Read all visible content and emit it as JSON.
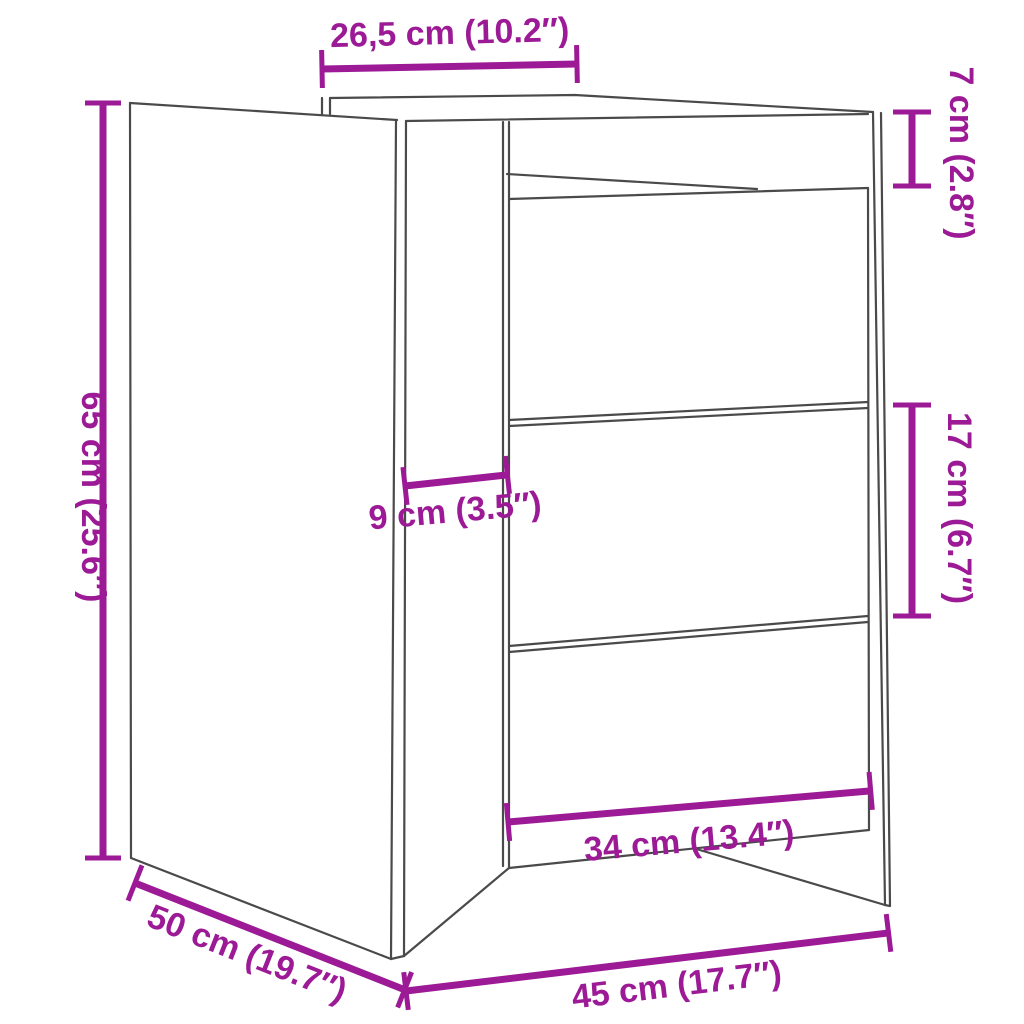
{
  "figure": {
    "kind": "furniture-dimension-diagram",
    "subject": "bedside cabinet with 3 drawers and open top compartment, perspective line drawing",
    "colors": {
      "dimension_accent": "#9c1a96",
      "drawing_outline": "#4a4a4a",
      "background": "#ffffff"
    }
  },
  "labels": {
    "top_depth": "26,5 cm (10.2″)",
    "top_section_height": "7 cm (2.8″)",
    "overall_height": "65 cm (25.6″)",
    "front_inset": "9 cm (3.5″)",
    "drawer_height": "17 cm (6.7″)",
    "drawer_width": "34 cm (13.4″)",
    "overall_depth": "50 cm (19.7″)",
    "overall_width": "45 cm (17.7″)"
  }
}
